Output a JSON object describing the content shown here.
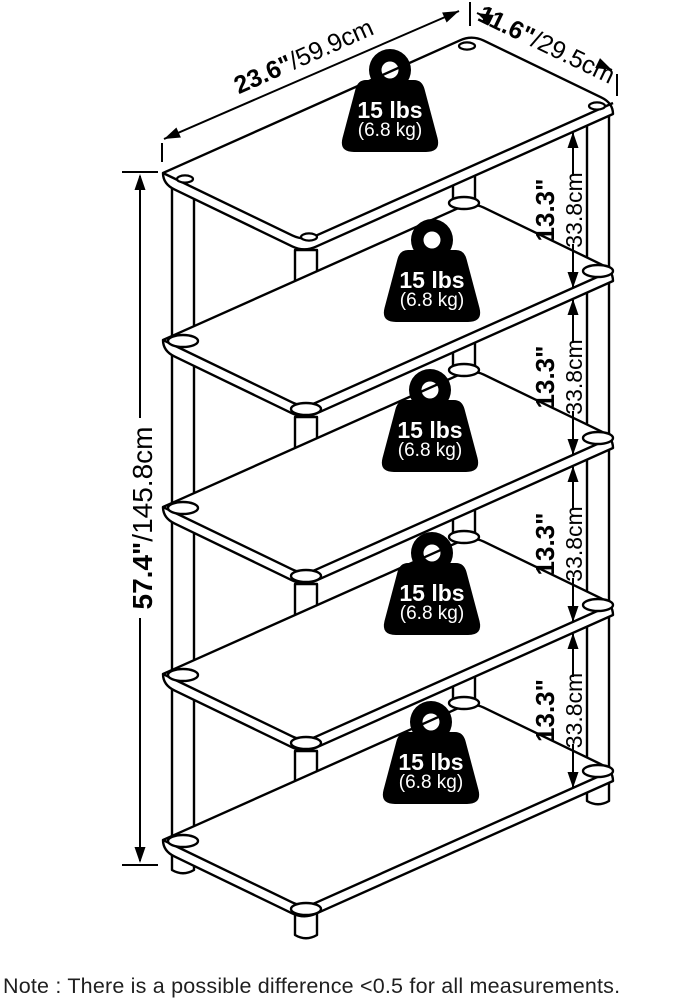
{
  "diagram": {
    "note": "Note : There is a possible difference <0.5 for all measurements.",
    "dimensions": {
      "width": {
        "inches": "23.6\"",
        "metric": "/59.9cm"
      },
      "depth": {
        "inches": "11.6\"",
        "metric": "/29.5cm"
      },
      "height": {
        "inches": "57.4\"",
        "metric": "/145.8cm"
      },
      "shelf_spacing": {
        "inches": "13.3\"",
        "metric": "33.8cm"
      }
    },
    "load_badge": {
      "pounds": "15 lbs",
      "kilograms": "(6.8 kg)"
    },
    "shelf_count": 5,
    "spacing_count": 4,
    "colors": {
      "line": "#000000",
      "badge_fill": "#000000",
      "badge_text": "#ffffff",
      "note_text": "#1f1f1f",
      "background": "#ffffff"
    }
  }
}
